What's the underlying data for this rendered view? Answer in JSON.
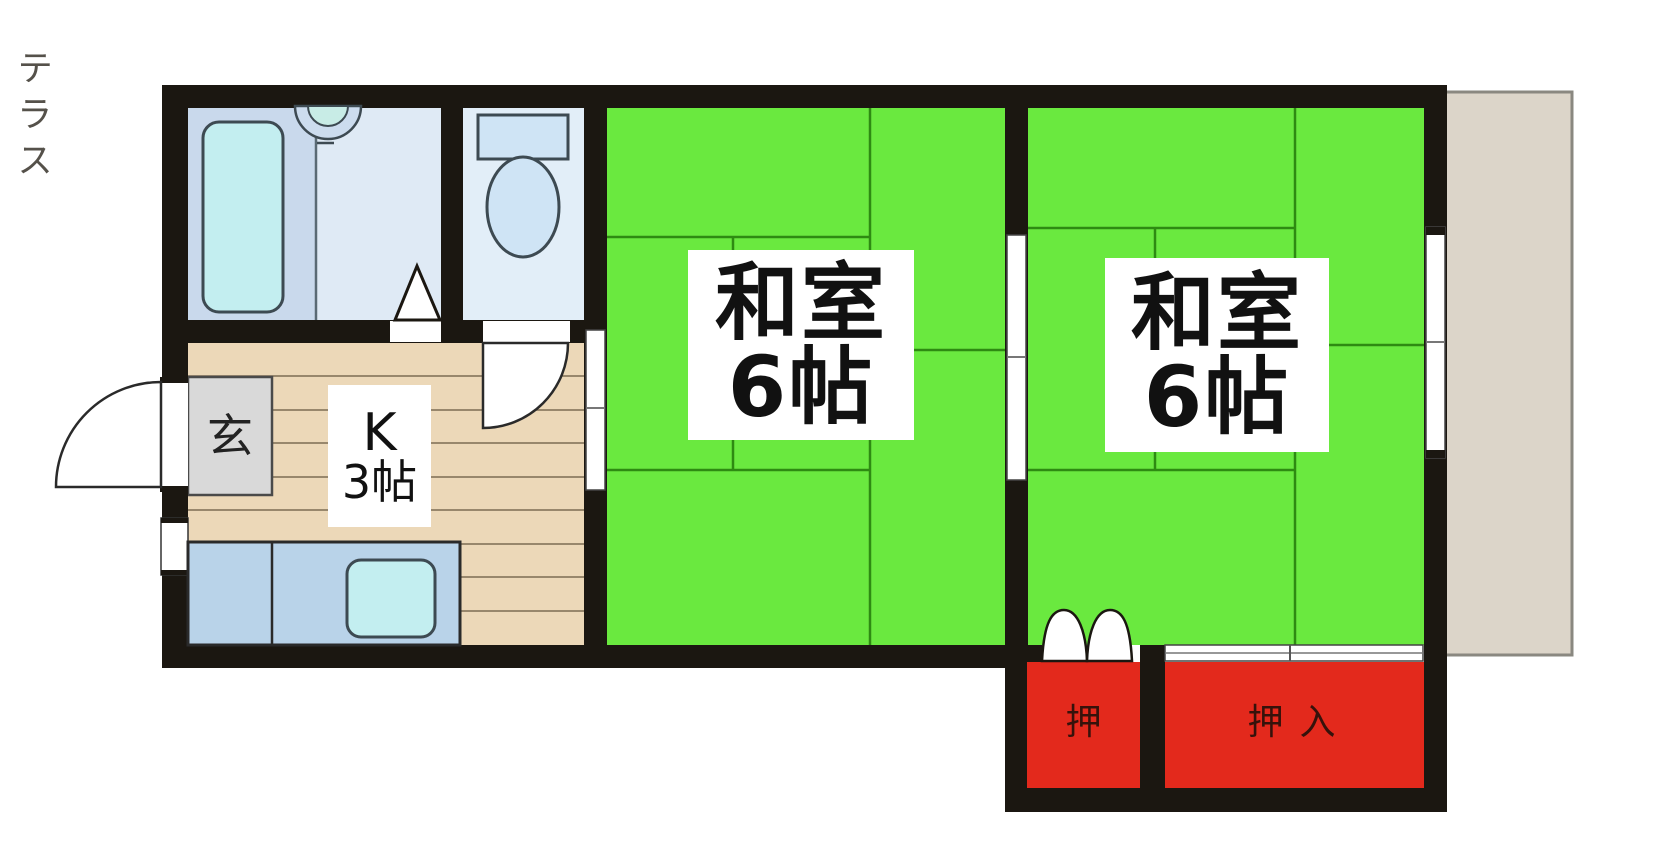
{
  "plan": {
    "entrance": {
      "label": "玄"
    },
    "kitchen": {
      "label_line1": "K",
      "label_line2": "3帖"
    },
    "tatami_room_1": {
      "label_line1": "和室",
      "label_line2": "6帖"
    },
    "tatami_room_2": {
      "label_line1": "和室",
      "label_line2": "6帖"
    },
    "terrace": {
      "label": "テラス"
    },
    "closet_small": {
      "label": "押"
    },
    "closet_large": {
      "label": "押入"
    },
    "colors": {
      "wall": "#1b1711",
      "tatami_green": "#6ae93f",
      "tatami_line": "#2e8a12",
      "closet_red": "#e3291c",
      "wood_floor": "#ecd8b8",
      "wood_line": "#7d6c52",
      "terrace_beige": "#dcd5c9",
      "terrace_text": "#55514a",
      "bath_floor": "#dfeaf5",
      "bath_tub_zone": "#c9d9ec",
      "toilet_floor": "#e2eef8",
      "water_cyan": "#c3eef0",
      "fixture_blue": "#cfe4f5",
      "counter_blue": "#b9d3e9",
      "genkan_gray": "#d9d9d9"
    }
  }
}
